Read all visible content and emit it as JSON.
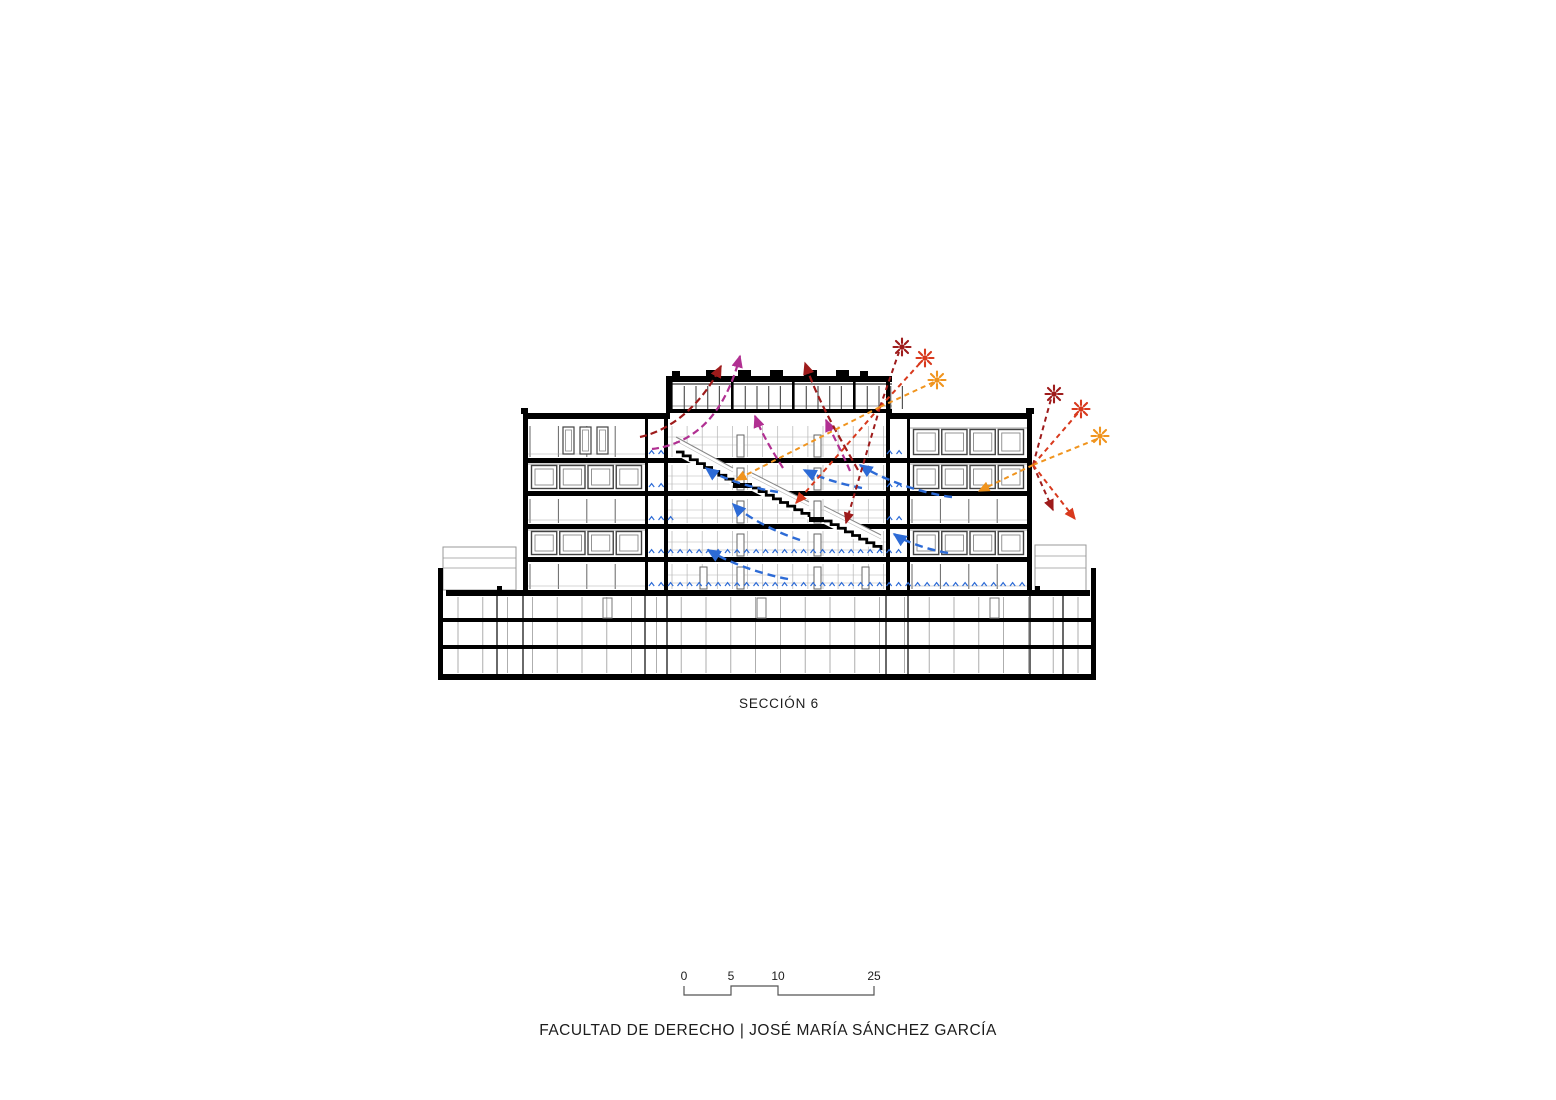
{
  "document": {
    "section_label": "SECCIÓN 6",
    "project_caption": "FACULTAD DE DERECHO | JOSÉ MARÍA SÁNCHEZ GARCÍA"
  },
  "scale_bar": {
    "labels": [
      "0",
      "5",
      "10",
      "25"
    ],
    "values_meters": [
      0,
      5,
      10,
      25
    ]
  },
  "colors": {
    "solar_deep": "#9E1B1B",
    "solar_mid": "#D8391D",
    "solar_low": "#F0941E",
    "exhaust": "#B13092",
    "cool_air": "#2D6BD6",
    "ink": "#000000",
    "line_gray": "#666666",
    "light_gray": "#9a9a9a"
  },
  "annotations": {
    "suns": [
      {
        "name": "sun-high-1",
        "x": 902,
        "y": 347,
        "tone": "solar_deep"
      },
      {
        "name": "sun-mid-1",
        "x": 925,
        "y": 358,
        "tone": "solar_mid"
      },
      {
        "name": "sun-low-1",
        "x": 937,
        "y": 380,
        "tone": "solar_low"
      },
      {
        "name": "sun-high-2",
        "x": 1054,
        "y": 394,
        "tone": "solar_deep"
      },
      {
        "name": "sun-mid-2",
        "x": 1081,
        "y": 409,
        "tone": "solar_mid"
      },
      {
        "name": "sun-low-2",
        "x": 1100,
        "y": 436,
        "tone": "solar_low"
      }
    ],
    "arrows": [
      {
        "name": "cool-air-arrow-1",
        "tone": "cool_air",
        "head": true,
        "dash": "8 5",
        "w": 2.4,
        "path": "M778,492 C750,488 718,477 706,468"
      },
      {
        "name": "cool-air-arrow-2",
        "tone": "cool_air",
        "head": true,
        "dash": "8 5",
        "w": 2.4,
        "path": "M862,488 C840,484 818,477 804,470"
      },
      {
        "name": "cool-air-arrow-3",
        "tone": "cool_air",
        "head": true,
        "dash": "8 5",
        "w": 2.4,
        "path": "M952,497 C918,493 878,477 860,465"
      },
      {
        "name": "cool-air-arrow-4",
        "tone": "cool_air",
        "head": true,
        "dash": "8 5",
        "w": 2.4,
        "path": "M800,540 C772,531 744,515 733,504"
      },
      {
        "name": "cool-air-arrow-5",
        "tone": "cool_air",
        "head": true,
        "dash": "8 5",
        "w": 2.4,
        "path": "M948,553 C925,549 904,541 894,534"
      },
      {
        "name": "cool-air-arrow-6",
        "tone": "cool_air",
        "head": true,
        "dash": "8 5",
        "w": 2.4,
        "path": "M788,579 C756,573 726,561 708,550"
      },
      {
        "name": "exhaust-air-arrow-1",
        "tone": "exhaust",
        "head": true,
        "dash": "7 4",
        "w": 2.2,
        "path": "M652,449 C700,443 727,407 740,356"
      },
      {
        "name": "exhaust-air-arrow-2",
        "tone": "exhaust",
        "head": true,
        "dash": "7 4",
        "w": 2.2,
        "path": "M850,471 C843,454 833,436 826,420"
      },
      {
        "name": "exhaust-air-arrow-3",
        "tone": "exhaust",
        "head": true,
        "dash": "7 4",
        "w": 2.2,
        "path": "M783,468 C771,449 761,432 755,416"
      },
      {
        "name": "heat-rise-arrow-1",
        "tone": "solar_deep",
        "head": true,
        "dash": "7 4",
        "w": 2.2,
        "path": "M640,437 C672,430 702,404 721,366"
      },
      {
        "name": "heat-rise-arrow-2",
        "tone": "solar_deep",
        "head": true,
        "dash": "7 4",
        "w": 2.2,
        "path": "M858,470 C840,438 818,402 805,363"
      },
      {
        "name": "sun-ray-1a",
        "tone": "solar_deep",
        "head": false,
        "dash": "5 4",
        "w": 2,
        "path": "M880,407 L899,352"
      },
      {
        "name": "sun-ray-1b",
        "tone": "solar_mid",
        "head": false,
        "dash": "5 4",
        "w": 2,
        "path": "M880,407 L922,361"
      },
      {
        "name": "sun-ray-1c",
        "tone": "solar_low",
        "head": false,
        "dash": "5 4",
        "w": 2,
        "path": "M880,407 L934,382"
      },
      {
        "name": "solar-gain-arrow-1a",
        "tone": "solar_deep",
        "head": true,
        "dash": "5 4",
        "w": 2,
        "path": "M880,407 L846,523"
      },
      {
        "name": "solar-gain-arrow-1b",
        "tone": "solar_mid",
        "head": true,
        "dash": "5 4",
        "w": 2,
        "path": "M880,407 L796,503"
      },
      {
        "name": "solar-gain-arrow-1c",
        "tone": "solar_low",
        "head": true,
        "dash": "5 4",
        "w": 2,
        "path": "M880,407 L736,480"
      },
      {
        "name": "sun-ray-2a",
        "tone": "solar_deep",
        "head": false,
        "dash": "5 4",
        "w": 2,
        "path": "M1033,465 L1051,399"
      },
      {
        "name": "sun-ray-2b",
        "tone": "solar_mid",
        "head": false,
        "dash": "5 4",
        "w": 2,
        "path": "M1033,465 L1078,413"
      },
      {
        "name": "sun-ray-2c",
        "tone": "solar_low",
        "head": false,
        "dash": "5 4",
        "w": 2,
        "path": "M1033,465 L1097,439"
      },
      {
        "name": "solar-gain-arrow-2a",
        "tone": "solar_deep",
        "head": true,
        "dash": "5 4",
        "w": 2,
        "path": "M1033,465 L1053,510"
      },
      {
        "name": "solar-gain-arrow-2b",
        "tone": "solar_mid",
        "head": true,
        "dash": "5 4",
        "w": 2,
        "path": "M1033,465 L1075,519"
      },
      {
        "name": "solar-gain-arrow-2c",
        "tone": "solar_low",
        "head": true,
        "dash": "5 4",
        "w": 2,
        "path": "M1033,465 L979,491"
      }
    ],
    "air_supply_rows": [
      {
        "y": 451,
        "segments": [
          [
            649,
            667
          ],
          [
            887,
            907
          ]
        ]
      },
      {
        "y": 484,
        "segments": [
          [
            649,
            667
          ],
          [
            887,
            907
          ]
        ]
      },
      {
        "y": 517,
        "segments": [
          [
            649,
            676
          ],
          [
            887,
            907
          ]
        ]
      },
      {
        "y": 550,
        "segments": [
          [
            649,
            907
          ]
        ]
      },
      {
        "y": 583,
        "segments": [
          [
            649,
            1026
          ]
        ]
      }
    ]
  }
}
